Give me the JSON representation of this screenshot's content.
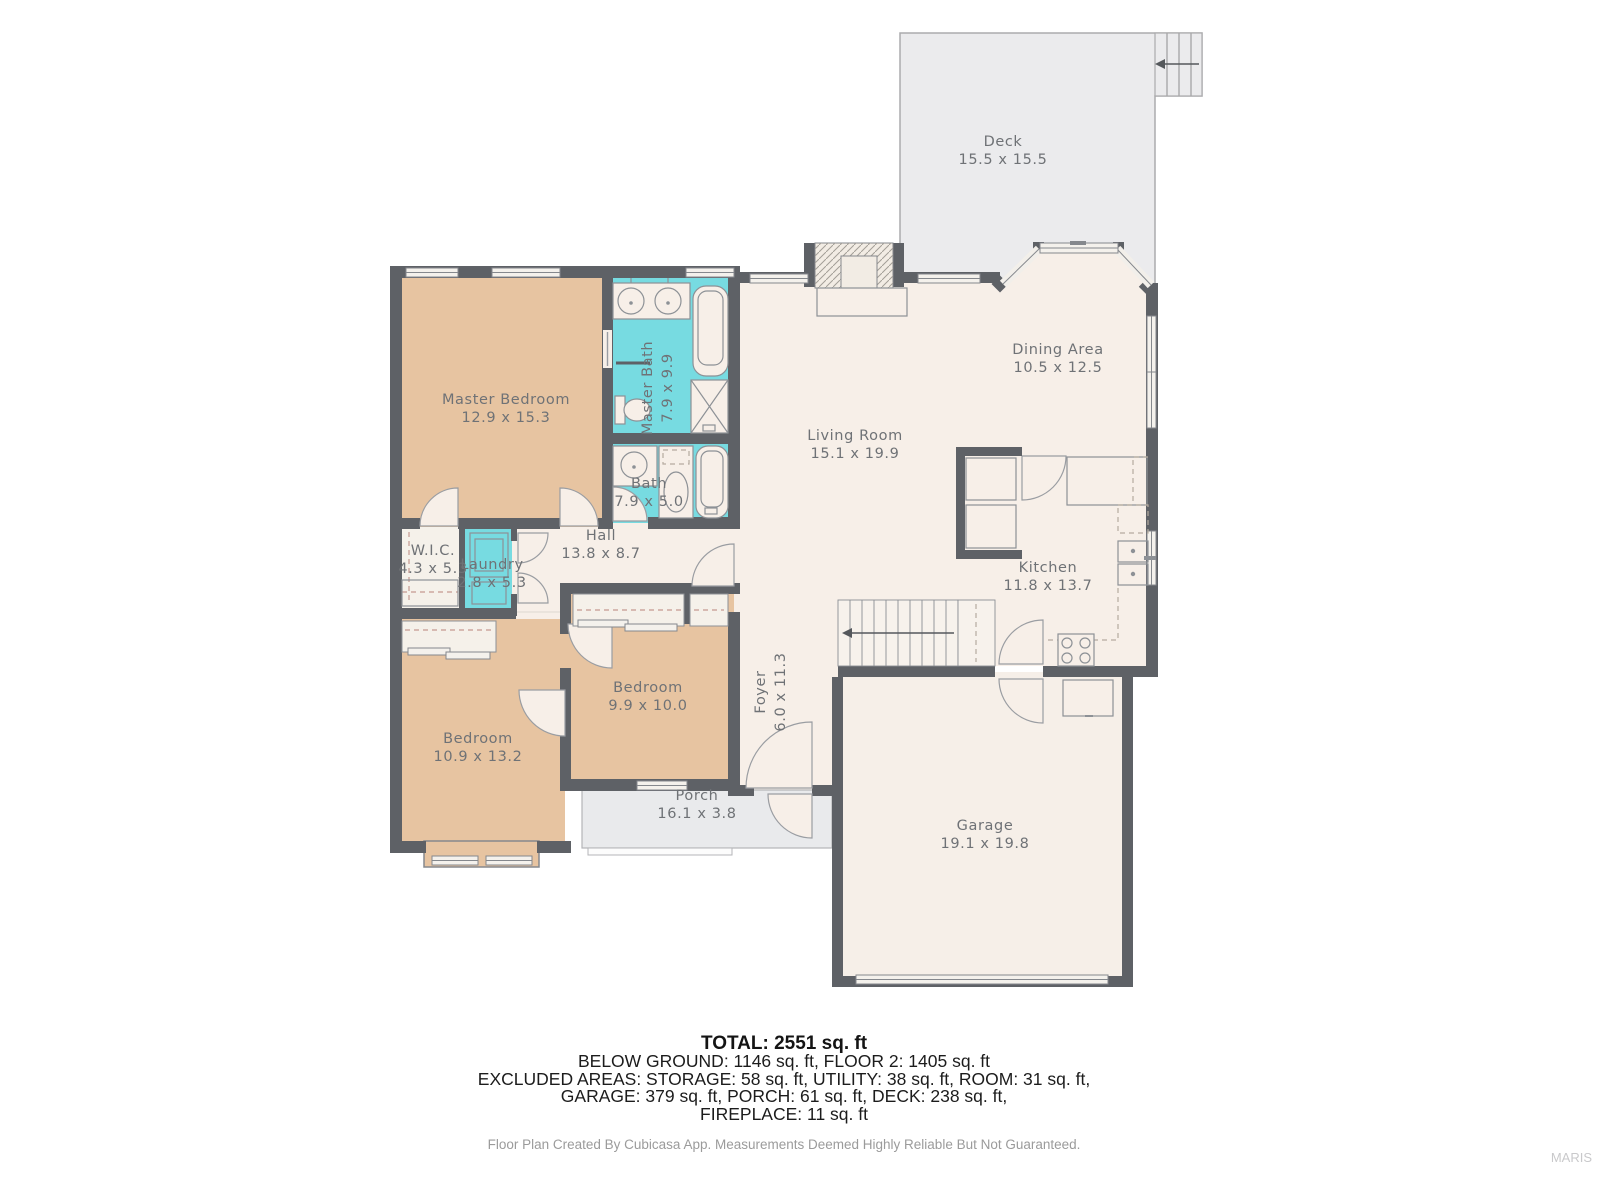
{
  "rooms": {
    "deck": {
      "label": "Deck",
      "dims": "15.5 x 15.5"
    },
    "master_bedroom": {
      "label": "Master Bedroom",
      "dims": "12.9 x 15.3"
    },
    "master_bath": {
      "label": "Master Bath",
      "dims": "7.9 x 9.9"
    },
    "bath": {
      "label": "Bath",
      "dims": "7.9 x 5.0"
    },
    "hall": {
      "label": "Hall",
      "dims": "13.8 x 8.7"
    },
    "wic": {
      "label": "W.I.C.",
      "dims": "4.3 x 5.3"
    },
    "laundry": {
      "label": "Laundry",
      "dims": "2.8 x 5.3"
    },
    "living_room": {
      "label": "Living Room",
      "dims": "15.1 x 19.9"
    },
    "dining_area": {
      "label": "Dining Area",
      "dims": "10.5 x 12.5"
    },
    "kitchen": {
      "label": "Kitchen",
      "dims": "11.8 x 13.7"
    },
    "foyer": {
      "label": "Foyer",
      "dims": "6.0 x 11.3"
    },
    "bedroom_2": {
      "label": "Bedroom",
      "dims": "9.9 x 10.0"
    },
    "bedroom_1": {
      "label": "Bedroom",
      "dims": "10.9 x 13.2"
    },
    "porch": {
      "label": "Porch",
      "dims": "16.1 x 3.8"
    },
    "garage": {
      "label": "Garage",
      "dims": "19.1 x 19.8"
    }
  },
  "summary": {
    "total": "TOTAL: 2551 sq. ft",
    "line2": "BELOW GROUND: 1146 sq. ft, FLOOR 2: 1405 sq. ft",
    "line3": "EXCLUDED AREAS: STORAGE: 58 sq. ft, UTILITY: 38 sq. ft, ROOM: 31 sq. ft,",
    "line4": "GARAGE: 379 sq. ft, PORCH: 61 sq. ft, DECK: 238 sq. ft,",
    "line5": "FIREPLACE: 11 sq. ft"
  },
  "footer": {
    "disclaimer": "Floor Plan Created By Cubicasa App. Measurements Deemed Highly Reliable But Not Guaranteed.",
    "watermark": "MARIS"
  },
  "colors": {
    "wall": "#5e6166",
    "floor": "#f7efe8",
    "bedroom": "#e7c4a1",
    "bath": "#77dbe1",
    "deck": "#ebebed",
    "porch": "#e9eaec"
  }
}
